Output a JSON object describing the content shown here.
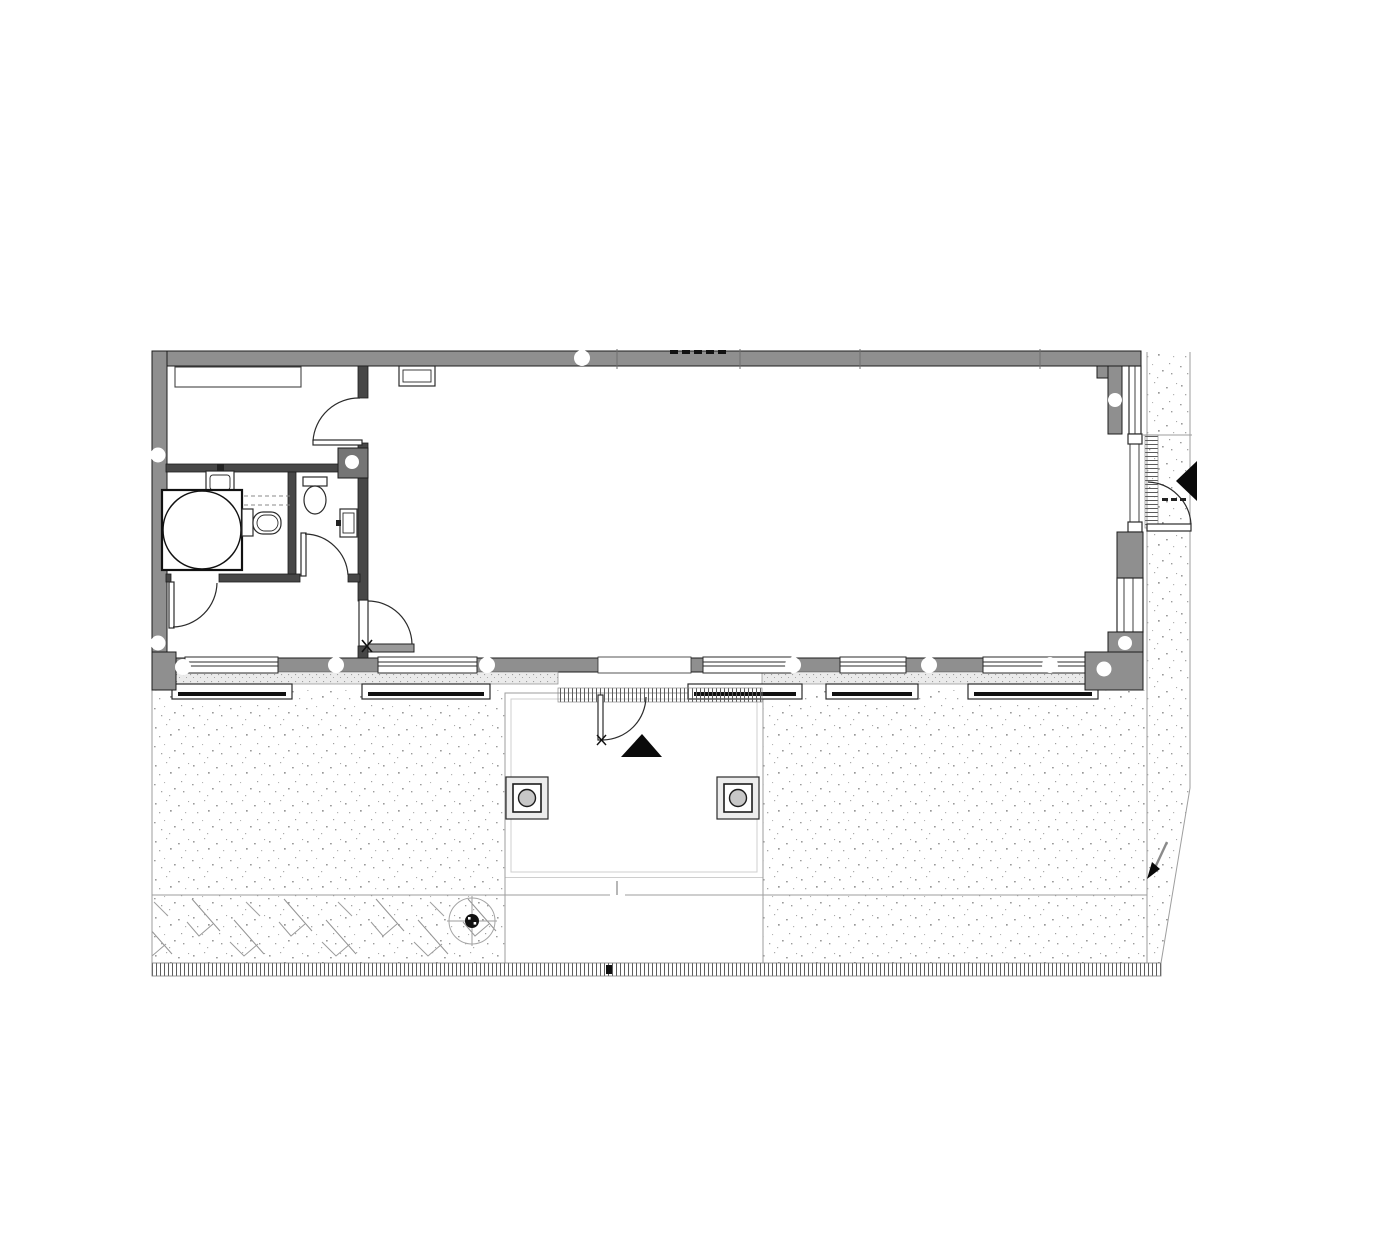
{
  "drawing": {
    "kind": "architectural-floor-plan",
    "colors": {
      "paper": "#ffffff",
      "wall_fill": "#8f8f8f",
      "wall_edge": "#1c1c1c",
      "partition_fill": "#474747",
      "shaft_fill": "#757575",
      "line_dark": "#2b2b2b",
      "line_light": "#9e9e9e",
      "sill_band": "#ebebeb",
      "speck": "#9c9c9c",
      "arrow_black": "#0a0a0a",
      "post_fill": "#ececec",
      "post_circle": "#c7c7c7",
      "door_leaf_gray": "#9a9a9a"
    },
    "rooms": [
      {
        "name": "main-hall"
      },
      {
        "name": "top-left-room"
      },
      {
        "name": "bathroom"
      },
      {
        "name": "wc"
      },
      {
        "name": "lower-left-room"
      }
    ],
    "doors": [
      {
        "name": "top-left-room-door"
      },
      {
        "name": "wc-door"
      },
      {
        "name": "lower-left-room-door"
      },
      {
        "name": "hall-partition-door"
      },
      {
        "name": "patio-door"
      },
      {
        "name": "main-entrance-door"
      }
    ],
    "fixtures": [
      {
        "name": "counter"
      },
      {
        "name": "radiator"
      },
      {
        "name": "wash-basin"
      },
      {
        "name": "turning-circle"
      },
      {
        "name": "toilet-bathroom"
      },
      {
        "name": "toilet-wc"
      },
      {
        "name": "hand-basin-wc"
      },
      {
        "name": "duct-shaft"
      }
    ],
    "site": [
      {
        "name": "patio-terrace"
      },
      {
        "name": "walkway"
      },
      {
        "name": "gravel-ground-left"
      },
      {
        "name": "gravel-ground-right"
      },
      {
        "name": "gravel-strip-outside-east"
      },
      {
        "name": "planting-bed"
      },
      {
        "name": "tree-point-marker"
      },
      {
        "name": "boundary-fence"
      },
      {
        "name": "scale-tick-strip"
      },
      {
        "name": "terrace-post",
        "count": 2
      },
      {
        "name": "entry-arrow",
        "count": 2
      },
      {
        "name": "window-sill",
        "count": 5
      }
    ]
  }
}
